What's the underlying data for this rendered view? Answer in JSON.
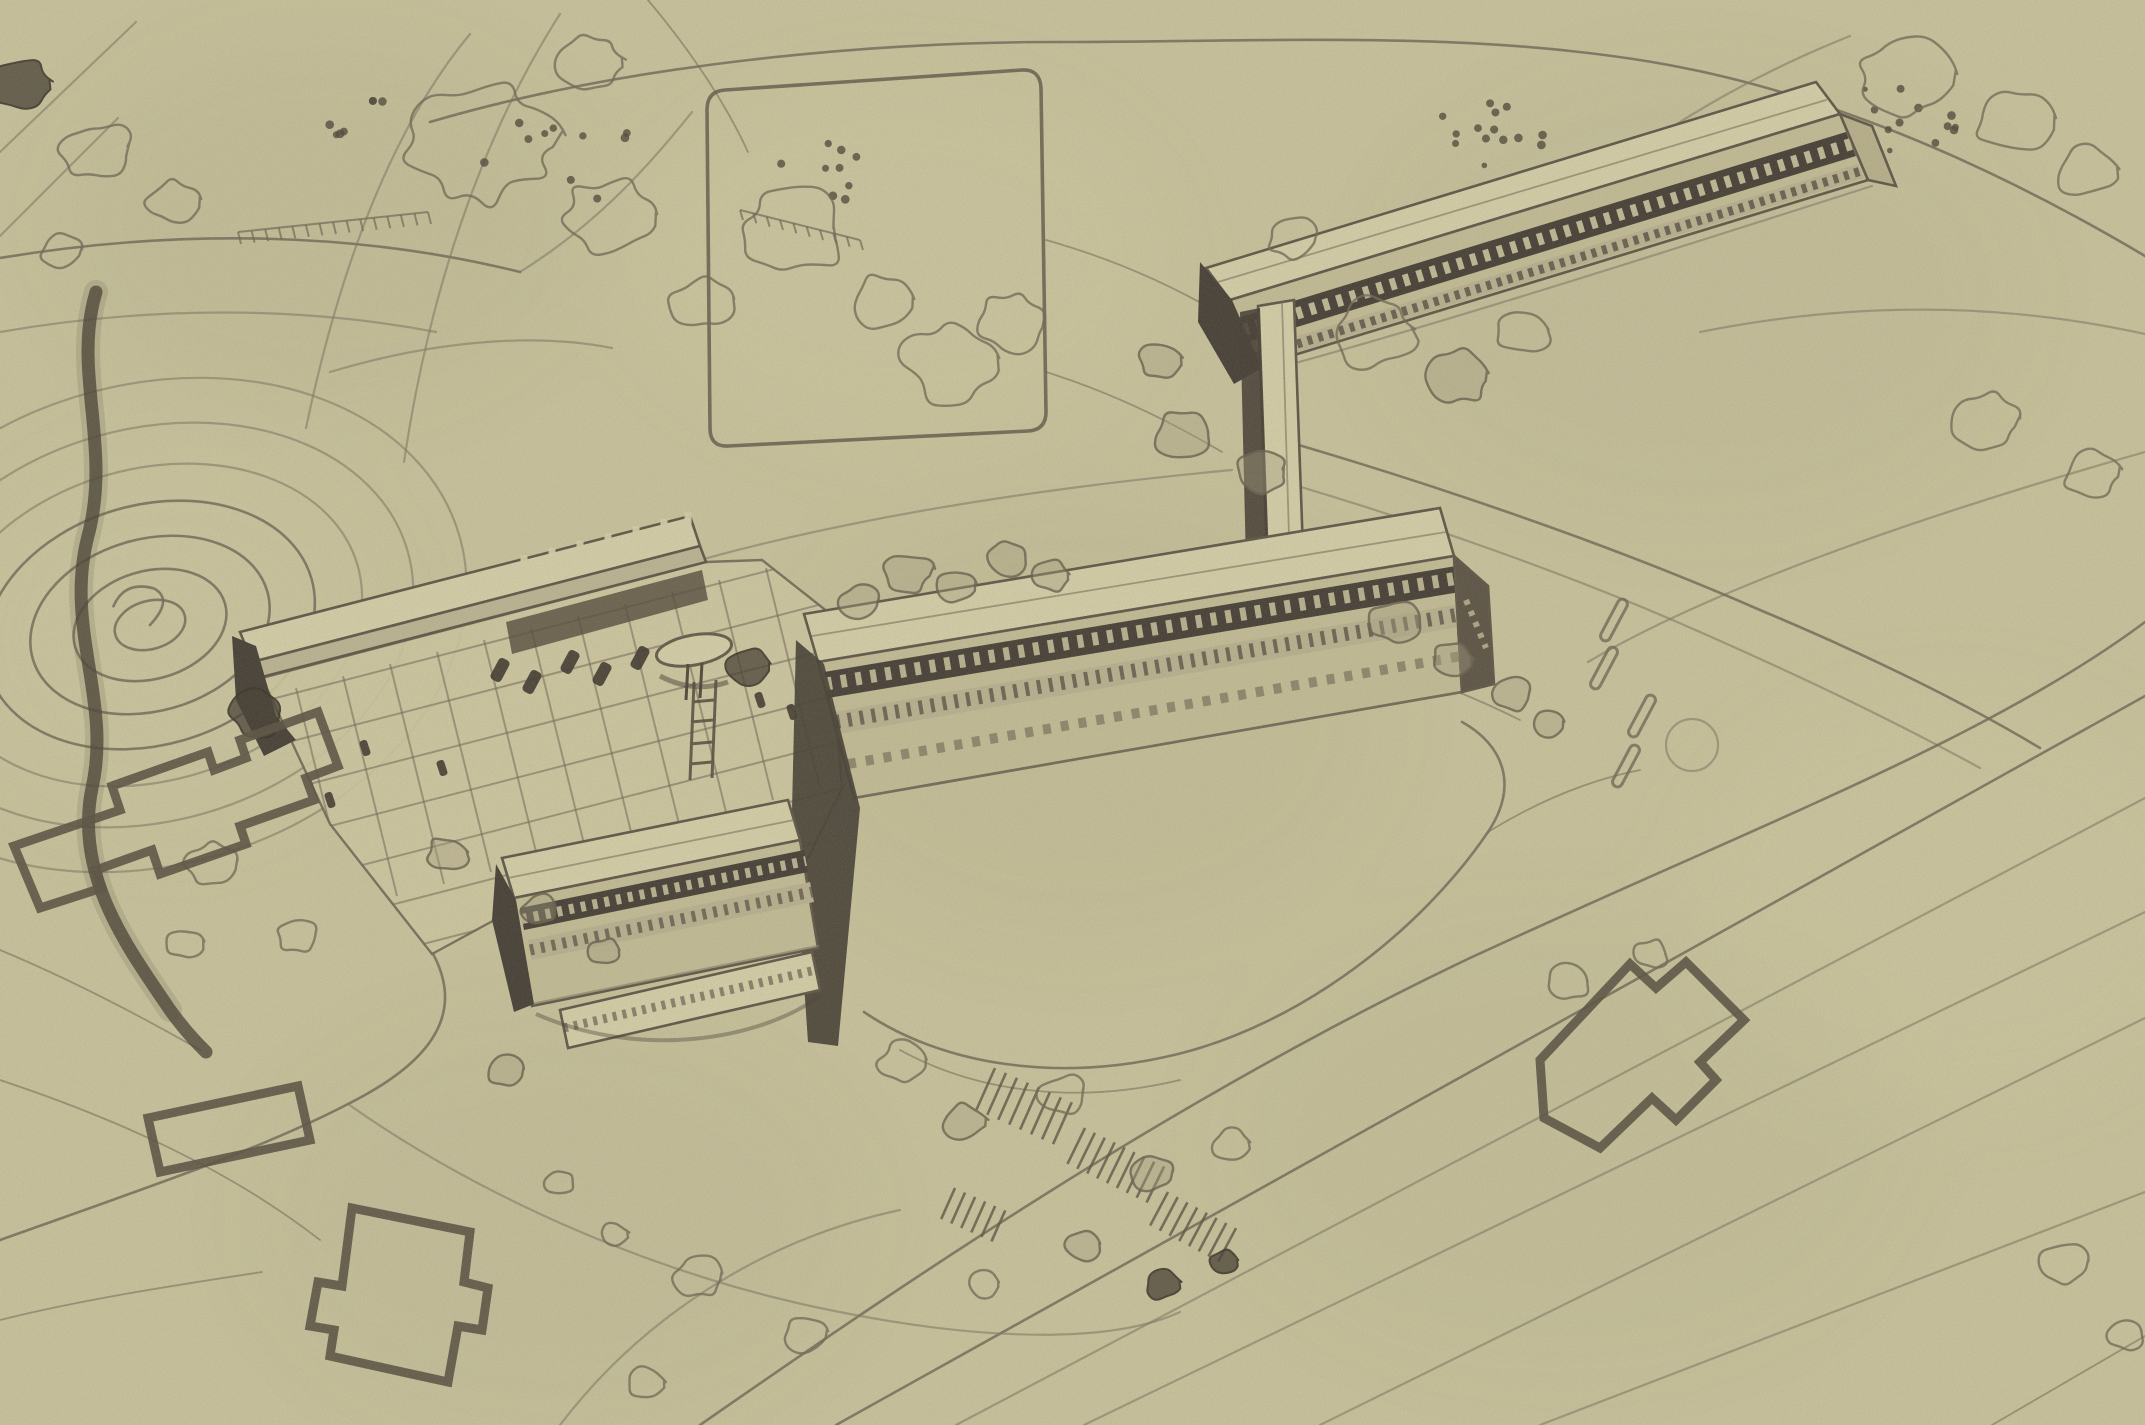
{
  "meta": {
    "artifact": "hand-drawn aerial perspective site sketch",
    "medium": "ink line drawing on aged olive paper, halftone print scan",
    "visible_text": "none"
  },
  "palette": {
    "paper": "#c6c099",
    "paper_light": "#d2cca5",
    "paper_shade": "#b2aa89",
    "facade_shade": "#c0b992",
    "band_mid": "#b6ae8c",
    "line": "#6b6150",
    "line_soft": "#7d7460",
    "ink_dark": "#403930",
    "ink_deep": "#332d25"
  },
  "scene": {
    "ground": {
      "label": "rolling site with contour lines, roads and woodland"
    },
    "hill": {
      "label": "contoured hill with concentric rings",
      "rings": 7
    },
    "sports_field": {
      "label": "empty rectangular playing field outline"
    },
    "stream": {
      "label": "dark stream gully along upper left edge"
    },
    "buildings": [
      {
        "id": "north-slab",
        "label": "long slab block with ribbon windows, upper right"
      },
      {
        "id": "stair-tower",
        "label": "tall stair / chimney tower linking the slabs"
      },
      {
        "id": "main-slab",
        "label": "long central slab with clerestory band and window rows"
      },
      {
        "id": "front-slab",
        "label": "lower three-storey slab in front left"
      },
      {
        "id": "entrance-canopy",
        "label": "columned entrance canopy along the forecourt"
      }
    ],
    "forecourt": {
      "label": "paved forecourt grid with parked cars, figures and round kiosk",
      "cars": 5
    },
    "footprints": {
      "label": "heavy-outline existing building footprints",
      "count": 4
    },
    "gardens": {
      "label": "terraced gardens with stair flights below the main slab"
    },
    "roads": {
      "label": "curving site roads with parallel edge lines and lane dashes"
    }
  }
}
